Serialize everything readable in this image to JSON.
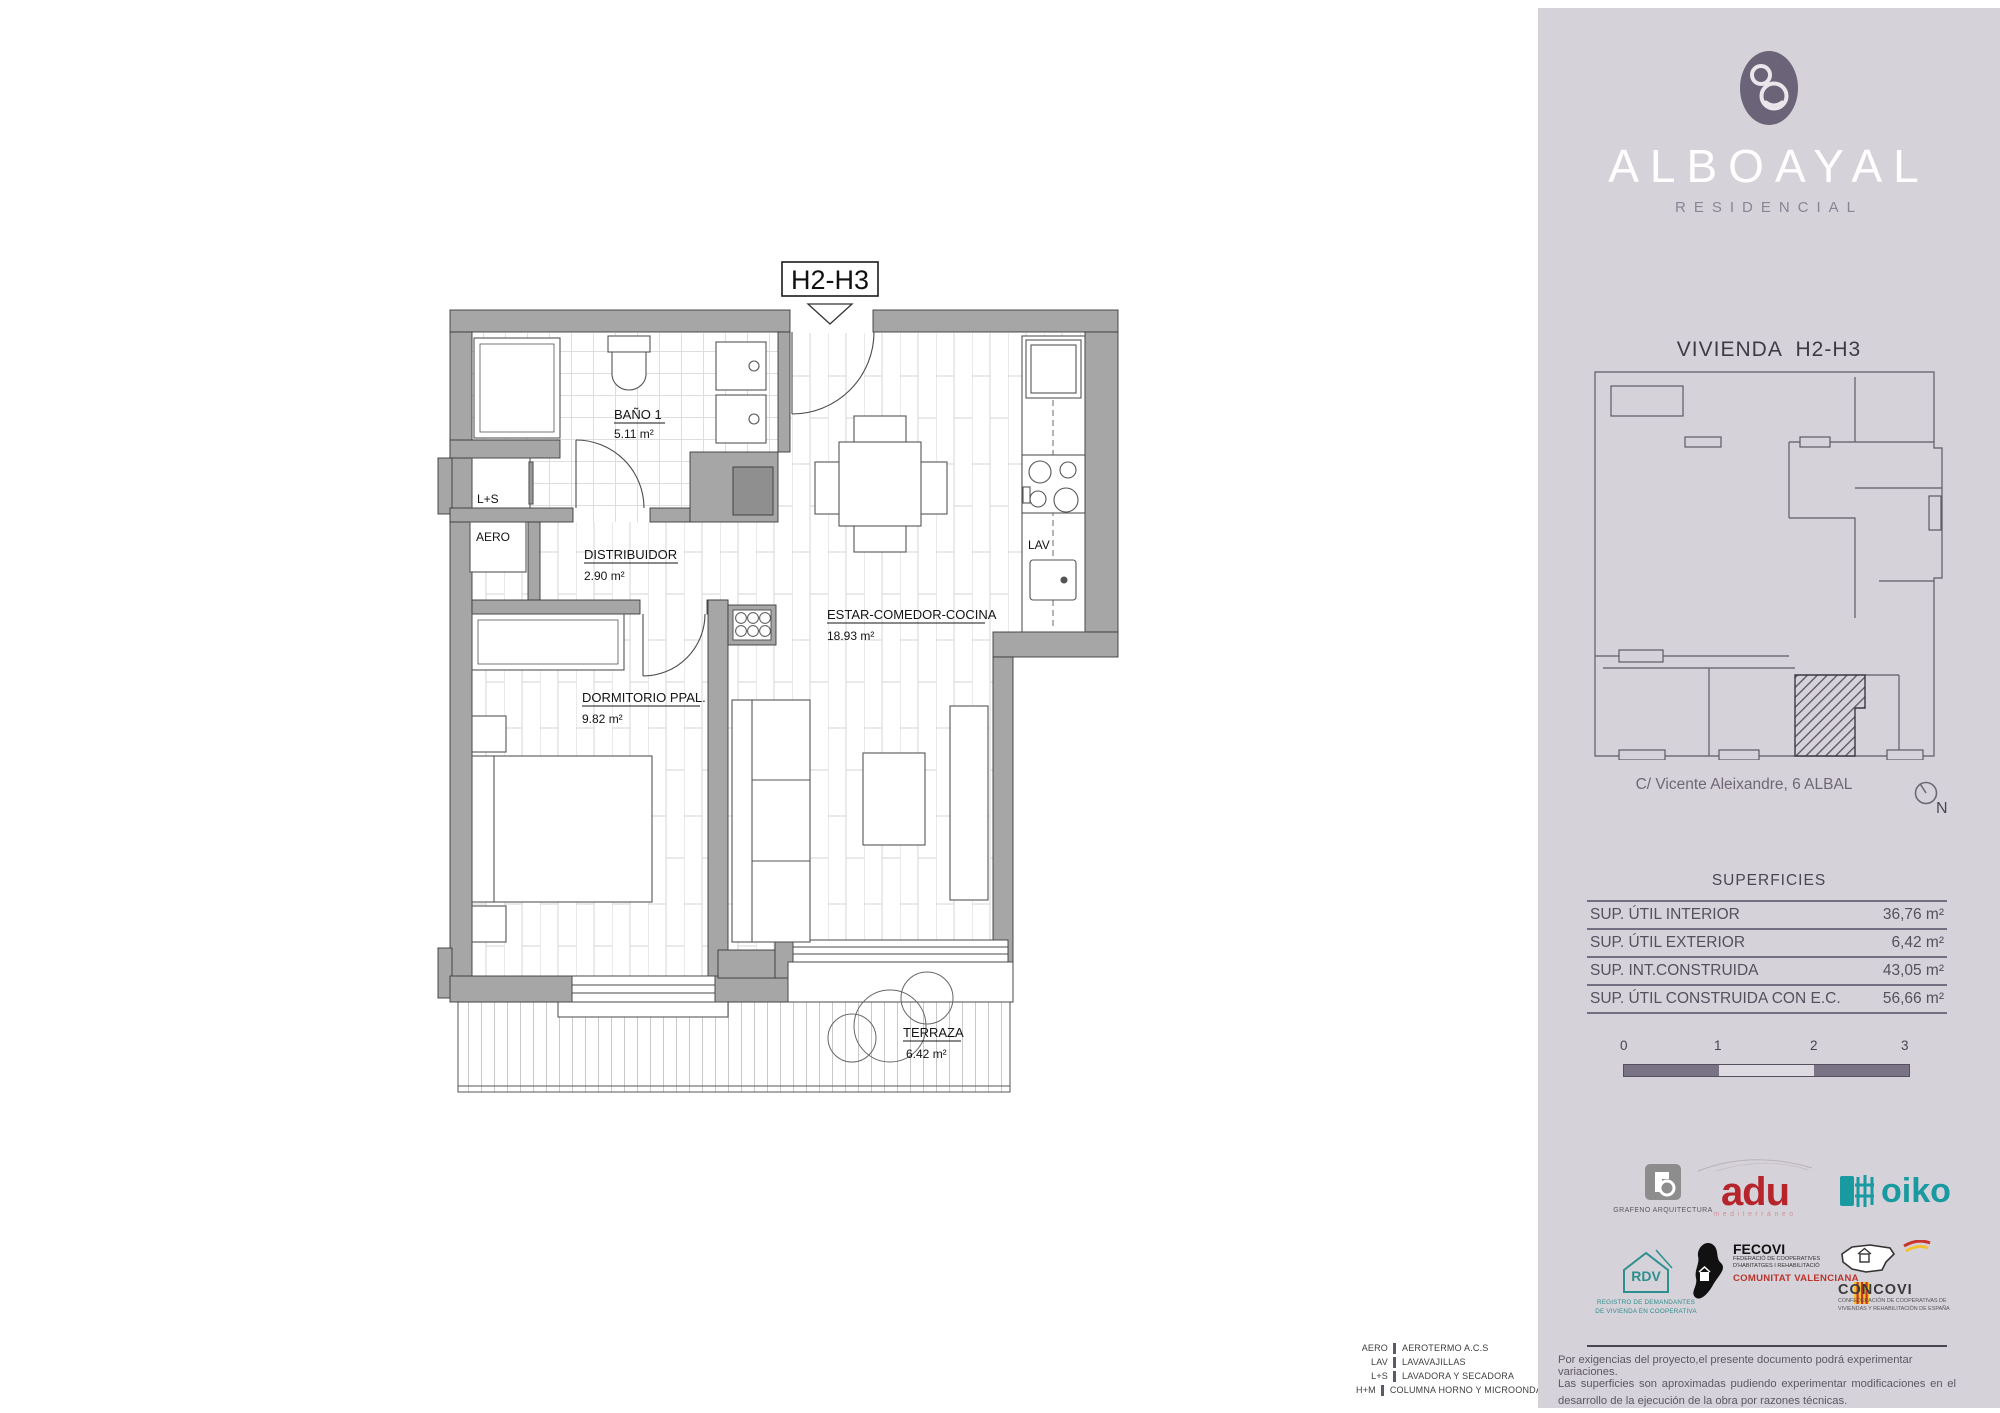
{
  "plan": {
    "unit_tag": "H2-H3",
    "rooms": [
      {
        "name": "BAÑO 1",
        "area": "5.11 m²"
      },
      {
        "name": "DISTRIBUIDOR",
        "area": "2.90 m²"
      },
      {
        "name": "DORMITORIO PPAL.",
        "area": "9.82 m²"
      },
      {
        "name": "ESTAR-COMEDOR-COCINA",
        "area": "18.93 m²"
      },
      {
        "name": "TERRAZA",
        "area": "6.42 m²"
      }
    ],
    "fixtures": {
      "ls_label": "L+S",
      "aero_label": "AERO",
      "lav_label": "LAV"
    }
  },
  "legend": {
    "rows": [
      {
        "abbr": "AERO",
        "desc": "AEROTERMO A.C.S"
      },
      {
        "abbr": "LAV",
        "desc": "LAVAVAJILLAS"
      },
      {
        "abbr": "L+S",
        "desc": "LAVADORA Y SECADORA"
      },
      {
        "abbr": "H+M",
        "desc": "COLUMNA HORNO Y MICROONDAS"
      }
    ]
  },
  "sidebar": {
    "brand": {
      "name": "ALBOAYAL",
      "tagline": "RESIDENCIAL"
    },
    "heading": "VIVIENDA H2-H3",
    "address": "C/ Vicente Aleixandre, 6 ALBAL",
    "compass_label": "N",
    "superficies": {
      "title": "SUPERFICIES",
      "rows": [
        {
          "label": "SUP. ÚTIL INTERIOR",
          "value": "36,76 m²"
        },
        {
          "label": "SUP. ÚTIL EXTERIOR",
          "value": "6,42 m²"
        },
        {
          "label": "SUP. INT.CONSTRUIDA",
          "value": "43,05 m²"
        },
        {
          "label": "SUP. ÚTIL CONSTRUIDA CON E.C.",
          "value": "56,66 m²"
        }
      ]
    },
    "scalebar": {
      "labels": [
        "0",
        "1",
        "2",
        "3"
      ]
    },
    "logos": {
      "grafeno": {
        "caption": "GRAFENO ARQUITECTURA"
      },
      "adu": {
        "name": "adu",
        "sub": "mediterráneo"
      },
      "oiko": {
        "name": "oiko"
      },
      "rdv": {
        "name": "RDV",
        "caption1": "REGISTRO DE DEMANDANTES",
        "caption2": "DE VIVIENDA EN COOPERATIVA"
      },
      "fecovi": {
        "name": "FECOVI",
        "line1": "FEDERACIÓ DE COOPERATIVES",
        "line2": "D'HABITATGES I REHABILITACIÓ",
        "line3": "COMUNITAT VALENCIANA"
      },
      "concovi": {
        "name": "CONCOVI",
        "line1": "CONFEDERACIÓN DE COOPERATIVAS DE",
        "line2": "VIVIENDAS Y REHABILITACIÓN DE ESPAÑA"
      }
    },
    "disclaimer": {
      "line1": "Por exigencias del proyecto,el presente documento podrá experimentar variaciones.",
      "line2": "Las superficies son aproximadas pudiendo experimentar modificaciones en el desarrollo de la ejecución de la obra por razones técnicas."
    },
    "colors": {
      "panel_bg": "#d6d2d9",
      "brand_plum": "#6b6377",
      "table_line": "#756e80",
      "adu_red": "#b5252b",
      "oiko_teal": "#189aa0",
      "rdv_teal": "#2d8f8f"
    }
  }
}
